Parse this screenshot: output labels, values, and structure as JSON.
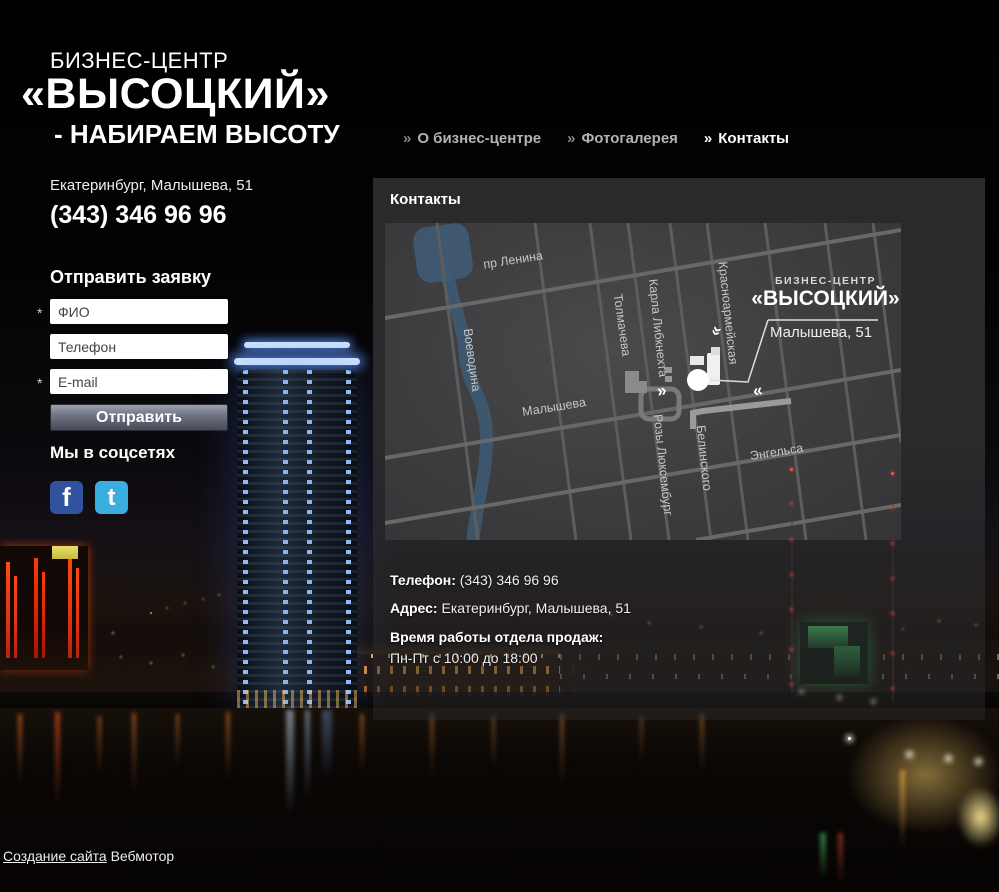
{
  "logo": {
    "line1": "БИЗНЕС-ЦЕНТР",
    "line2": "«ВЫСОЦКИЙ»",
    "line3": "- НАБИРАЕМ ВЫСОТУ"
  },
  "contact_top": {
    "address": "Екатеринбург, Малышева, 51",
    "phone": "(343) 346 96 96"
  },
  "nav": {
    "marker": "»",
    "items": [
      {
        "label": "О бизнес-центре"
      },
      {
        "label": "Фотогалерея"
      },
      {
        "label": "Контакты"
      }
    ]
  },
  "form": {
    "title": "Отправить заявку",
    "required_mark": "*",
    "fields": [
      {
        "placeholder": "ФИО",
        "required": true
      },
      {
        "placeholder": "Телефон",
        "required": false
      },
      {
        "placeholder": "E-mail",
        "required": true
      }
    ],
    "submit_label": "Отправить"
  },
  "social": {
    "title": "Мы в соцсетях",
    "icons": [
      {
        "name": "facebook",
        "glyph": "f",
        "color": "#31529e"
      },
      {
        "name": "twitter",
        "glyph": "t",
        "color": "#3aaede"
      }
    ]
  },
  "content": {
    "title": "Контакты",
    "map": {
      "streets": [
        "пр Ленина",
        "Воеводина",
        "Толмачева",
        "Карла Либкнехта",
        "Красноармейская",
        "Малышева",
        "Розы Люксембург",
        "Белинского",
        "Энгельса"
      ],
      "callout": {
        "line1": "БИЗНЕС-ЦЕНТР",
        "line2": "«ВЫСОЦКИЙ»",
        "line3": "Малышева, 51"
      },
      "chevrons": {
        "left": "«",
        "right": "»"
      }
    },
    "info": [
      {
        "label": "Телефон:",
        "value": "(343) 346 96 96"
      },
      {
        "label": "Адрес:",
        "value": "Екатеринбург, Малышева, 51"
      },
      {
        "label": "Время работы отдела продаж:",
        "value": "Пн-Пт с 10:00 до 18:00"
      }
    ]
  },
  "footer": {
    "link_label": "Создание сайта",
    "site_name": "Вебмотор"
  }
}
